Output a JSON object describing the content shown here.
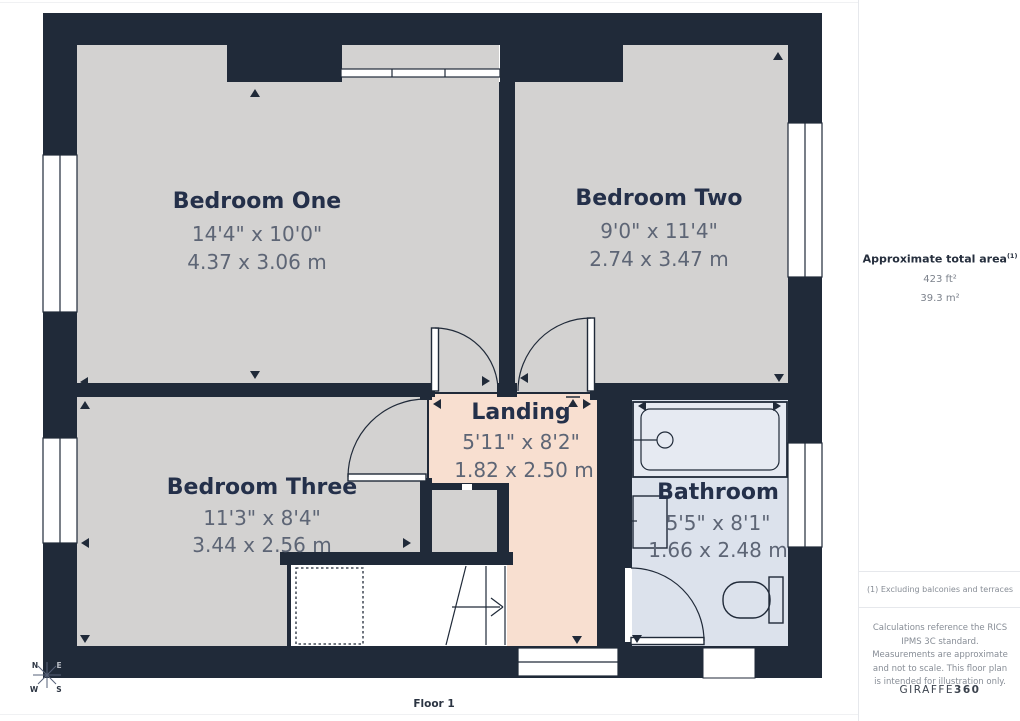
{
  "page": {
    "floor_label": "Floor 1"
  },
  "rooms": [
    {
      "name": "Bedroom One",
      "imperial": "14'4\" x 10'0\"",
      "metric": "4.37 x 3.06 m"
    },
    {
      "name": "Bedroom Two",
      "imperial": "9'0\" x 11'4\"",
      "metric": "2.74 x 3.47 m"
    },
    {
      "name": "Bedroom Three",
      "imperial": "11'3\" x 8'4\"",
      "metric": "3.44 x 2.56 m"
    },
    {
      "name": "Landing",
      "imperial": "5'11\" x 8'2\"",
      "metric": "1.82 x 2.50 m"
    },
    {
      "name": "Bathroom",
      "imperial": "5'5\" x 8'1\"",
      "metric": "1.66 x 2.48 m"
    }
  ],
  "compass": {
    "north": "N",
    "east": "E",
    "south": "S",
    "west": "W"
  },
  "sidebar": {
    "area_title": "Approximate total area",
    "area_note_ref": "(1)",
    "area_imperial": "423 ft²",
    "area_metric": "39.3 m²",
    "footnote": "(1) Excluding balconies and terraces",
    "disclaimer": "Calculations reference the RICS IPMS 3C standard. Measurements are approximate and not to scale. This floor plan is intended for illustration only.",
    "brand": {
      "name": "GIRAFFE",
      "suffix": "360"
    }
  },
  "colors": {
    "wall": "#202a39",
    "bedroom_floor": "#d3d2d1",
    "landing_floor": "#f8dfd0",
    "bathroom_floor": "#dce2ec",
    "bathtub_fill": "#e6eaf2"
  }
}
